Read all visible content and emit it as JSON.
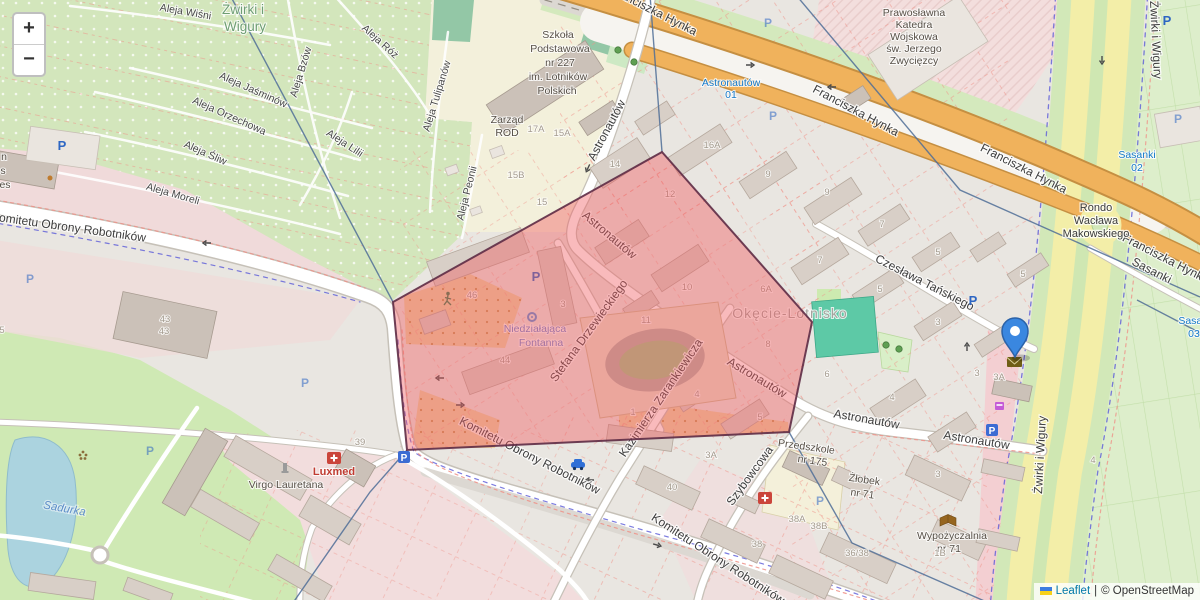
{
  "ui": {
    "zoom_in": "+",
    "zoom_out": "−",
    "attribution": {
      "leaflet": "Leaflet",
      "sep": "|",
      "osm": "© OpenStreetMap"
    }
  },
  "colors": {
    "marker": "#3a87e0",
    "marker_border": "#2b62a8",
    "selection_fill": "rgba(240,90,95,0.42)",
    "selection_stroke": "#5e2b45",
    "leaflet_link": "#0078A8"
  },
  "labels": {
    "streets": [
      {
        "t": "Komitetu Obrony Robotników",
        "x": 68,
        "y": 231,
        "r": 8
      },
      {
        "t": "Komitetu Obrony Robotników",
        "x": 528,
        "y": 459,
        "r": 27
      },
      {
        "t": "Komitetu Obrony Robotników",
        "x": 716,
        "y": 562,
        "r": 33
      },
      {
        "t": "Astronautów",
        "x": 610,
        "y": 132,
        "r": -62
      },
      {
        "t": "Astronautów",
        "x": 607,
        "y": 238,
        "r": 40
      },
      {
        "t": "Astronautów",
        "x": 755,
        "y": 381,
        "r": 31
      },
      {
        "t": "Astronautów",
        "x": 866,
        "y": 423,
        "r": 10
      },
      {
        "t": "Astronautów",
        "x": 976,
        "y": 444,
        "r": 9
      },
      {
        "t": "Stefana Drzewieckiego",
        "x": 592,
        "y": 333,
        "r": -54
      },
      {
        "t": "Kazimierza Zarankiewicza",
        "x": 664,
        "y": 400,
        "r": -56
      },
      {
        "t": "Szybowcowa",
        "x": 753,
        "y": 478,
        "r": -54
      },
      {
        "t": "Czesława Tańskiego",
        "x": 923,
        "y": 286,
        "r": 27
      },
      {
        "t": "Franciszka Hynka",
        "x": 652,
        "y": 14,
        "r": 27
      },
      {
        "t": "Franciszka Hynka",
        "x": 854,
        "y": 114,
        "r": 28
      },
      {
        "t": "Franciszka Hynka",
        "x": 1022,
        "y": 172,
        "r": 27
      },
      {
        "t": "Franciszka Hynka",
        "x": 1164,
        "y": 262,
        "r": 27
      },
      {
        "t": "Sasanki",
        "x": 1150,
        "y": 274,
        "r": 27
      },
      {
        "t": "Żwirki i Wigury",
        "x": 1152,
        "y": 40,
        "r": 87
      },
      {
        "t": "Żwirki i Wigury",
        "x": 1044,
        "y": 455,
        "r": -87
      },
      {
        "t": "Rondo",
        "x": 1096,
        "y": 211,
        "cls": "lbl st-md"
      },
      {
        "t": "Wacława",
        "x": 1096,
        "y": 224,
        "cls": "lbl st-md"
      },
      {
        "t": "Makowskiego",
        "x": 1096,
        "y": 237,
        "cls": "lbl st-md"
      },
      {
        "t": "Aleja Wiśni",
        "x": 185,
        "y": 15,
        "r": 10,
        "cls": "lbl st-sm"
      },
      {
        "t": "Aleja Róż",
        "x": 378,
        "y": 44,
        "r": 42,
        "cls": "lbl st-sm"
      },
      {
        "t": "Aleja Bzów",
        "x": 304,
        "y": 73,
        "r": -73,
        "cls": "lbl st-sm"
      },
      {
        "t": "Aleja Tulipanów",
        "x": 440,
        "y": 97,
        "r": -73,
        "cls": "lbl st-sm"
      },
      {
        "t": "Aleja Jaśminów",
        "x": 252,
        "y": 93,
        "r": 24,
        "cls": "lbl st-sm"
      },
      {
        "t": "Aleja Orzechowa",
        "x": 228,
        "y": 119,
        "r": 24,
        "cls": "lbl st-sm"
      },
      {
        "t": "Aleja Lilii",
        "x": 343,
        "y": 146,
        "r": 33,
        "cls": "lbl st-sm"
      },
      {
        "t": "Aleja Śliw",
        "x": 204,
        "y": 156,
        "r": 24,
        "cls": "lbl st-sm"
      },
      {
        "t": "Aleja Moreli",
        "x": 172,
        "y": 197,
        "r": 16,
        "cls": "lbl st-sm"
      },
      {
        "t": "Aleja Peonii",
        "x": 470,
        "y": 194,
        "r": -76,
        "cls": "lbl st-sm"
      }
    ],
    "areas": [
      {
        "t": "Żwirki i",
        "x": 243,
        "y": 14,
        "cls": "lbl area-green"
      },
      {
        "t": "Wigury",
        "x": 245,
        "y": 31,
        "cls": "lbl area-green"
      },
      {
        "t": "Okęcie-Lotnisko",
        "x": 790,
        "y": 318,
        "cls": "lbl area-gray"
      },
      {
        "t": "Sadurka",
        "x": 64,
        "y": 512,
        "r": 10,
        "cls": "lbl water"
      }
    ],
    "pois": [
      {
        "t": "Szkoła",
        "x": 558,
        "y": 38
      },
      {
        "t": "Podstawowa",
        "x": 560,
        "y": 52
      },
      {
        "t": "nr 227",
        "x": 560,
        "y": 66
      },
      {
        "t": "im. Lotników",
        "x": 558,
        "y": 80
      },
      {
        "t": "Polskich",
        "x": 557,
        "y": 94
      },
      {
        "t": "Prawosławna",
        "x": 914,
        "y": 16
      },
      {
        "t": "Katedra",
        "x": 914,
        "y": 28
      },
      {
        "t": "Wojskowa",
        "x": 914,
        "y": 40
      },
      {
        "t": "św. Jerzego",
        "x": 914,
        "y": 52
      },
      {
        "t": "Zwycięzcy",
        "x": 914,
        "y": 64
      },
      {
        "t": "Zarząd",
        "x": 507,
        "y": 123
      },
      {
        "t": "ROD",
        "x": 507,
        "y": 136
      },
      {
        "t": "Niedziałająca",
        "x": 535,
        "y": 332,
        "cls": "lbl poi poi-blue"
      },
      {
        "t": "Fontanna",
        "x": 541,
        "y": 346,
        "cls": "lbl poi poi-blue"
      },
      {
        "t": "Virgo Lauretana",
        "x": 286,
        "y": 488
      },
      {
        "t": "Luxmed",
        "x": 334,
        "y": 475,
        "cls": "lbl poi poi-red"
      },
      {
        "t": "Przedszkole",
        "x": 806,
        "y": 450,
        "r": 8
      },
      {
        "t": "nr 175",
        "x": 812,
        "y": 464,
        "r": 8
      },
      {
        "t": "Żłobek",
        "x": 864,
        "y": 483,
        "r": 8
      },
      {
        "t": "nr 71",
        "x": 862,
        "y": 497,
        "r": 8
      },
      {
        "t": "Wypożyczalnia",
        "x": 952,
        "y": 539
      },
      {
        "t": "nr 71",
        "x": 949,
        "y": 552
      },
      {
        "t": "n",
        "x": 4,
        "y": 160
      },
      {
        "t": "s",
        "x": 3,
        "y": 174
      },
      {
        "t": "es",
        "x": 5,
        "y": 188
      }
    ],
    "bus_stops": [
      {
        "t": "Astronautów",
        "x": 731,
        "y": 86
      },
      {
        "t": "01",
        "x": 731,
        "y": 98
      },
      {
        "t": "Sasanki",
        "x": 1137,
        "y": 158
      },
      {
        "t": "02",
        "x": 1137,
        "y": 171
      },
      {
        "t": "Sasanki",
        "x": 1197,
        "y": 324
      },
      {
        "t": "03",
        "x": 1194,
        "y": 337
      }
    ],
    "house_numbers": [
      [
        536,
        132,
        "17A"
      ],
      [
        562,
        136,
        "15A"
      ],
      [
        516,
        178,
        "15B"
      ],
      [
        542,
        205,
        "15"
      ],
      [
        615,
        167,
        "14"
      ],
      [
        670,
        197,
        "12"
      ],
      [
        712,
        148,
        "16A"
      ],
      [
        768,
        177,
        "9"
      ],
      [
        827,
        195,
        "9"
      ],
      [
        882,
        227,
        "7"
      ],
      [
        820,
        263,
        "7"
      ],
      [
        880,
        292,
        "5"
      ],
      [
        766,
        292,
        "6A"
      ],
      [
        768,
        347,
        "8"
      ],
      [
        938,
        255,
        "5"
      ],
      [
        938,
        325,
        "3"
      ],
      [
        827,
        377,
        "6"
      ],
      [
        892,
        400,
        "4"
      ],
      [
        938,
        477,
        "3"
      ],
      [
        1023,
        277,
        "5"
      ],
      [
        977,
        376,
        "3"
      ],
      [
        999,
        380,
        "3A"
      ],
      [
        1093,
        463,
        "4"
      ],
      [
        472,
        298,
        "46"
      ],
      [
        505,
        363,
        "44"
      ],
      [
        563,
        307,
        "3"
      ],
      [
        687,
        290,
        "10"
      ],
      [
        646,
        323,
        "11"
      ],
      [
        633,
        415,
        "1"
      ],
      [
        697,
        397,
        "4"
      ],
      [
        760,
        420,
        "5"
      ],
      [
        672,
        490,
        "40"
      ],
      [
        711,
        458,
        "3A"
      ],
      [
        797,
        522,
        "38A"
      ],
      [
        819,
        529,
        "38B"
      ],
      [
        757,
        547,
        "38"
      ],
      [
        857,
        556,
        "36/38"
      ],
      [
        940,
        556,
        "1B"
      ],
      [
        360,
        445,
        "39"
      ],
      [
        165,
        322,
        "43"
      ],
      [
        164,
        334,
        "43"
      ],
      [
        2,
        333,
        "5"
      ]
    ],
    "parking": {
      "glyph": "P",
      "spots": [
        [
          62,
          150,
          0
        ],
        [
          768,
          27,
          1
        ],
        [
          1167,
          25,
          0
        ],
        [
          1178,
          123,
          1
        ],
        [
          30,
          283,
          1
        ],
        [
          536,
          281,
          0
        ],
        [
          973,
          305,
          0
        ],
        [
          150,
          455,
          1
        ],
        [
          305,
          387,
          1
        ],
        [
          820,
          505,
          1
        ],
        [
          773,
          120,
          1
        ]
      ],
      "boxes": [
        [
          404,
          457
        ],
        [
          992,
          430
        ]
      ]
    }
  }
}
